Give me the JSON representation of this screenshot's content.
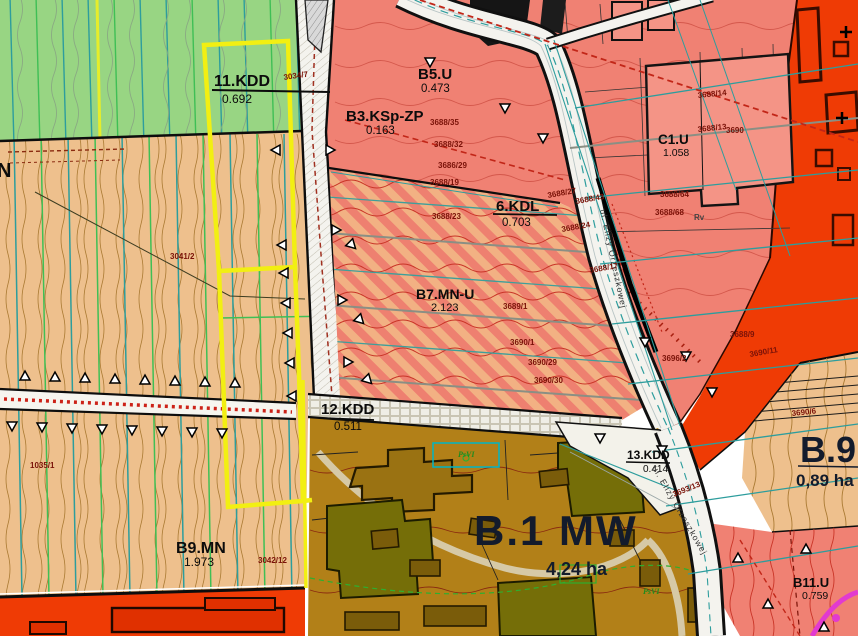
{
  "map": {
    "zones": [
      {
        "id": "11.KDD",
        "area": "0.692"
      },
      {
        "id": "B5.U",
        "area": "0.473"
      },
      {
        "id": "B3.KSp-ZP",
        "area": "0.163"
      },
      {
        "id": "6.KDL",
        "area": "0.703"
      },
      {
        "id": "B7.MN-U",
        "area": "2.123"
      },
      {
        "id": "C1.U",
        "area": "1.058"
      },
      {
        "id": "12.KDD",
        "area": "0.511"
      },
      {
        "id": "13.KDD",
        "area": "0.414"
      },
      {
        "id": "B.1 MW",
        "area": "4,24 ha"
      },
      {
        "id": "B9.MN",
        "area": "1.973"
      },
      {
        "id": "B.9",
        "area": "0,89 ha"
      },
      {
        "id": "B11.U",
        "area": "0.759"
      }
    ],
    "street_name": "ul. Elizy Orzeszkowej",
    "edge_label": "N",
    "land_class_labels": [
      "Rv",
      "PsVI",
      "PsVI"
    ],
    "parcel_numbers": [
      "3034/7",
      "3041/2",
      "3042/12",
      "1035/1",
      "3688/35",
      "3688/32",
      "3686/29",
      "3688/19",
      "3688/23",
      "3688/27",
      "3688/43",
      "3688/24",
      "3688/17",
      "3689/1",
      "3690/1",
      "3690/29",
      "3690/30",
      "3688/14",
      "3688/13",
      "3690",
      "3688/64",
      "3688/68",
      "3693/13",
      "3688/9",
      "3690/11",
      "3696/2",
      "3690/6"
    ],
    "colors": {
      "green_zone": "#98d583",
      "tan_zone": "#eec08d",
      "salmon_zone": "#f08173",
      "hatch_light": "#f2b183",
      "hatch_dark": "#ee8070",
      "bright_red_zone": "#ef3b05",
      "brown_zone": "#b28018",
      "olive_building": "#756e08",
      "highlight_outline": "#f2ef12",
      "utility_teal": "#2d9d9d",
      "magenta_line": "#e23ad0",
      "road_fill": "#f4f3ee"
    }
  }
}
